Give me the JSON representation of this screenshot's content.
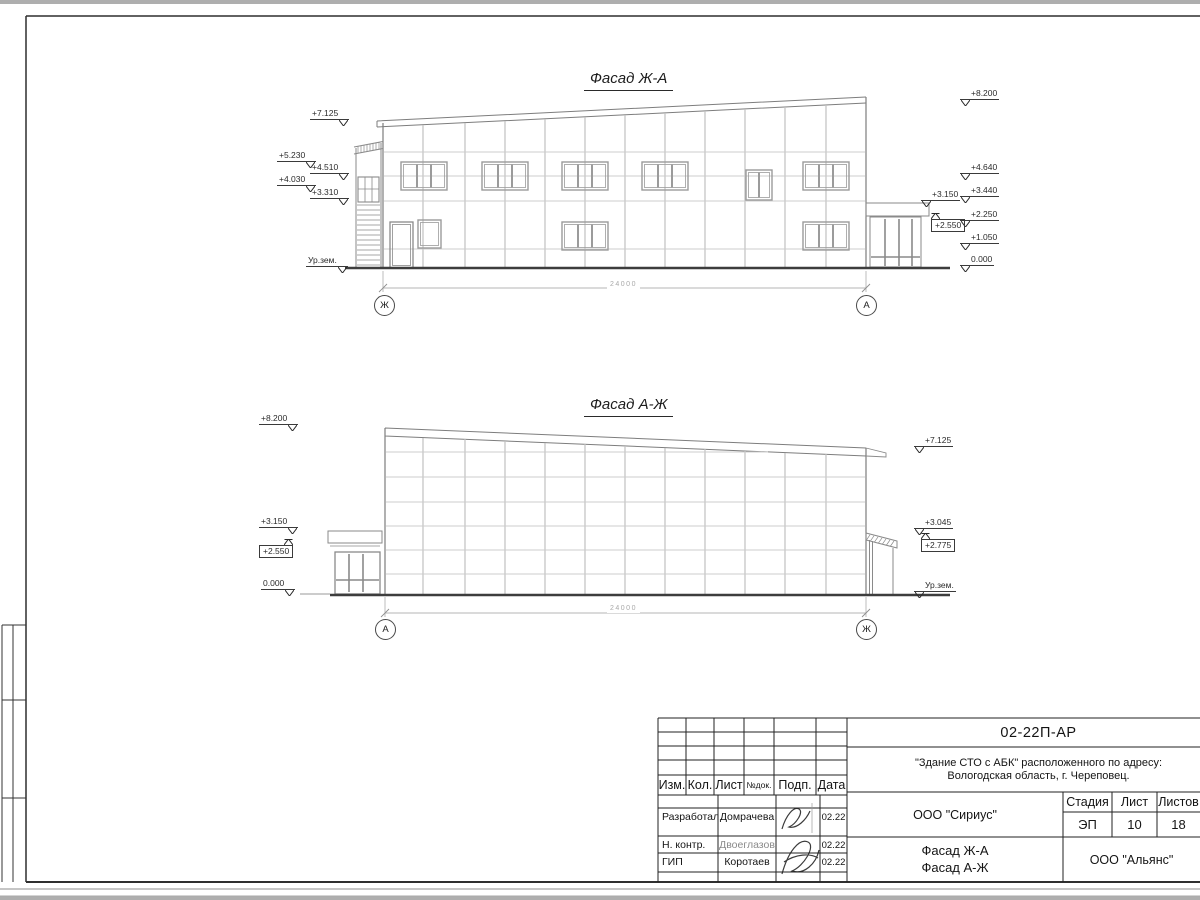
{
  "colors": {
    "frame": "#2a2a2a",
    "facade_outline": "#7d7d7d",
    "grid_line": "#c0c0c0",
    "joint_line": "#cccccc",
    "window_line": "#9b9b9b",
    "ground_line": "#3d3d3d",
    "dimension_line": "#b5b5b5",
    "text": "#141414"
  },
  "facade_top": {
    "title": "Фасад Ж-А",
    "dimension": "24000",
    "axis_left": "Ж",
    "axis_right": "А",
    "marks_left": [
      "+7.125",
      "+5.230",
      "+4.510",
      "+4.030",
      "+3.310",
      "Ур.зем."
    ],
    "marks_right": [
      "+8.200",
      "+4.640",
      "+3.440",
      "+2.250",
      "+1.050",
      "0.000"
    ],
    "marks_canopy": [
      "+3.150",
      "+2.550"
    ]
  },
  "facade_bottom": {
    "title": "Фасад А-Ж",
    "dimension": "24000",
    "axis_left": "А",
    "axis_right": "Ж",
    "marks_left": [
      "+8.200",
      "+3.150",
      "+2.550",
      "0.000"
    ],
    "marks_right": [
      "+7.125",
      "+3.045",
      "+2.775",
      "Ур.зем."
    ]
  },
  "title_block": {
    "doc_number": "02-22П-АР",
    "project_address_line1": "\"Здание СТО с АБК\" расположенного по адресу:",
    "project_address_line2": "Вологодская область, г. Череповец.",
    "columns": [
      "Изм.",
      "Кол.",
      "Лист",
      "№док.",
      "Подп.",
      "Дата"
    ],
    "stage_label": "Стадия",
    "sheet_label": "Лист",
    "sheets_label": "Листов",
    "stage": "ЭП",
    "sheet": "10",
    "sheets": "18",
    "designer_org": "ООО \"Сириус\"",
    "sheet_title_line1": "Фасад Ж-А",
    "sheet_title_line2": "Фасад А-Ж",
    "company": "ООО \"Альянс\"",
    "rows": [
      {
        "role": "Разработал",
        "name": "Домрачева",
        "date": "02.22"
      },
      {
        "role": "Н. контр.",
        "name": "Двоеглазов",
        "date": "02.22"
      },
      {
        "role": "ГИП",
        "name": "Коротаев",
        "date": "02.22"
      }
    ]
  }
}
